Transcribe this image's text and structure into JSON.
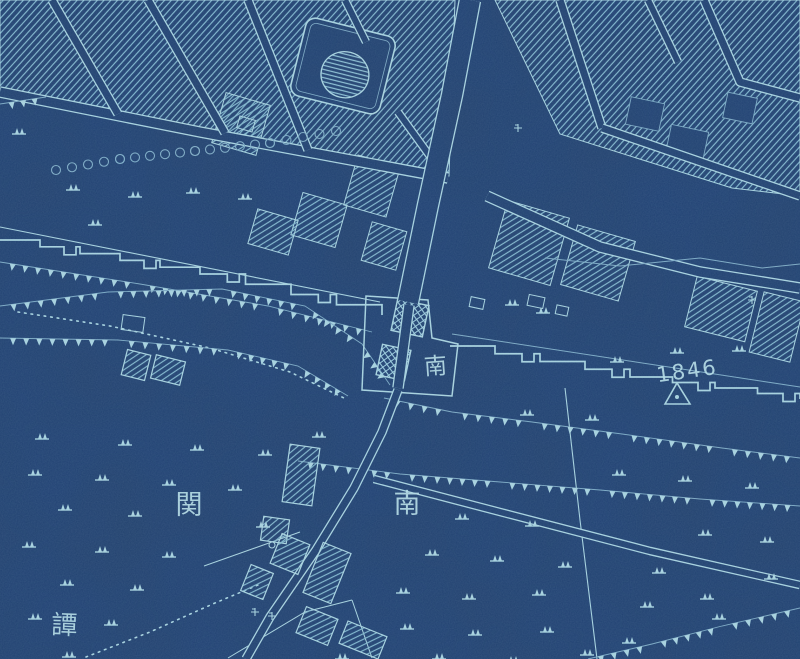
{
  "map": {
    "description_labels": {
      "gate_name": "南",
      "district_char_right": "南",
      "district_char_left": "関",
      "placename_partial": "譚",
      "survey_elevation": "1846"
    },
    "palette": {
      "background": "#21416d",
      "background_deep": "#1d3a63",
      "line": "#a9d1dd",
      "line_dim": "#7fa9c2",
      "hatch": "#84b6cb",
      "text": "#b6dae4"
    },
    "labels": [
      {
        "id": "gate-name-label",
        "text": "南",
        "x": 436,
        "y": 374,
        "size": 23,
        "rot": -4
      },
      {
        "id": "district-label-left",
        "text": "関",
        "x": 189,
        "y": 514,
        "size": 27,
        "rot": 0
      },
      {
        "id": "district-label-right",
        "text": "南",
        "x": 407,
        "y": 513,
        "size": 27,
        "rot": 0
      },
      {
        "id": "placename-label",
        "text": "譚",
        "x": 64,
        "y": 634,
        "size": 26,
        "rot": 2
      },
      {
        "id": "survey-elevation-label",
        "text": "1846",
        "x": 688,
        "y": 378,
        "size": 21,
        "rot": -8
      }
    ],
    "survey_marker": {
      "points": [
        [
          665,
          404
        ],
        [
          677,
          383
        ],
        [
          690,
          404
        ]
      ],
      "dot": [
        677,
        397
      ]
    },
    "geometry": {
      "block_polys": [
        [
          [
            0,
            0
          ],
          [
            455,
            0
          ],
          [
            449,
            176
          ],
          [
            0,
            95
          ]
        ],
        [
          [
            495,
            0
          ],
          [
            800,
            0
          ],
          [
            800,
            196
          ],
          [
            732,
            188
          ],
          [
            560,
            134
          ]
        ]
      ],
      "block_rects": [
        [
          296,
          198,
          46,
          44,
          16
        ],
        [
          350,
          160,
          44,
          52,
          16
        ],
        [
          366,
          226,
          36,
          40,
          16
        ],
        [
          252,
          214,
          42,
          36,
          16
        ],
        [
          218,
          98,
          46,
          52,
          16
        ],
        [
          497,
          208,
          64,
          70,
          16
        ],
        [
          568,
          232,
          60,
          62,
          16
        ],
        [
          690,
          283,
          62,
          52,
          14
        ],
        [
          756,
          296,
          42,
          62,
          14
        ]
      ],
      "court_rects": [
        [
          628,
          100,
          34,
          28,
          12
        ],
        [
          668,
          128,
          38,
          30,
          12
        ],
        [
          725,
          95,
          30,
          26,
          12
        ]
      ],
      "building_rects": [
        [
          124,
          352,
          24,
          26,
          14
        ],
        [
          153,
          358,
          30,
          24,
          14
        ],
        [
          286,
          446,
          30,
          58,
          8
        ],
        [
          262,
          518,
          26,
          24,
          8
        ],
        [
          275,
          538,
          30,
          32,
          22
        ],
        [
          312,
          546,
          30,
          54,
          22
        ],
        [
          245,
          568,
          24,
          28,
          22
        ],
        [
          300,
          612,
          34,
          28,
          22
        ],
        [
          342,
          628,
          42,
          24,
          22
        ]
      ],
      "outline_rects": [
        [
          122,
          316,
          22,
          15,
          8
        ],
        [
          238,
          118,
          16,
          12,
          16
        ],
        [
          528,
          296,
          16,
          11,
          12
        ],
        [
          556,
          306,
          12,
          9,
          12
        ],
        [
          470,
          298,
          14,
          10,
          12
        ]
      ],
      "gate_towers": [
        [
          394,
          302,
          32,
          32,
          12
        ],
        [
          379,
          347,
          29,
          31,
          12
        ]
      ],
      "gate_outline": [
        [
          366,
          296
        ],
        [
          362,
          390
        ],
        [
          452,
          396
        ],
        [
          458,
          344
        ],
        [
          432,
          338
        ],
        [
          428,
          300
        ]
      ],
      "enclosure": {
        "x": 297,
        "y": 26,
        "w": 92,
        "h": 80,
        "rot": 14,
        "rx": 10,
        "dome": {
          "cx": 347,
          "cy": 74,
          "rx": 24,
          "ry": 23
        }
      },
      "streets": [
        {
          "pts": [
            [
              0,
              92
            ],
            [
              200,
              132
            ],
            [
              448,
              178
            ]
          ],
          "w": 9
        },
        {
          "pts": [
            [
              487,
              196
            ],
            [
              600,
              247
            ],
            [
              700,
              272
            ],
            [
              800,
              288
            ]
          ],
          "w": 9
        },
        {
          "pts": [
            [
              52,
              0
            ],
            [
              118,
              114
            ]
          ],
          "w": 7
        },
        {
          "pts": [
            [
              148,
              0
            ],
            [
              225,
              133
            ]
          ],
          "w": 7
        },
        {
          "pts": [
            [
              248,
              0
            ],
            [
              308,
              150
            ]
          ],
          "w": 7
        },
        {
          "pts": [
            [
              345,
              0
            ],
            [
              366,
              42
            ]
          ],
          "w": 6
        },
        {
          "pts": [
            [
              398,
              112
            ],
            [
              440,
              170
            ]
          ],
          "w": 6
        },
        {
          "pts": [
            [
              560,
              0
            ],
            [
              602,
              128
            ]
          ],
          "w": 7
        },
        {
          "pts": [
            [
              648,
              0
            ],
            [
              678,
              62
            ]
          ],
          "w": 6
        },
        {
          "pts": [
            [
              704,
              0
            ],
            [
              740,
              82
            ],
            [
              800,
              98
            ]
          ],
          "w": 7
        },
        {
          "pts": [
            [
              602,
              128
            ],
            [
              800,
              196
            ]
          ],
          "w": 7
        }
      ],
      "roads": [
        {
          "pts": [
            [
              470,
              0
            ],
            [
              452,
              95
            ],
            [
              428,
              205
            ],
            [
              408,
              302
            ]
          ],
          "w": 20
        },
        {
          "pts": [
            [
              409,
              305
            ],
            [
              398,
              388
            ]
          ],
          "w": 9
        },
        {
          "pts": [
            [
              398,
              390
            ],
            [
              382,
              432
            ],
            [
              354,
              488
            ],
            [
              316,
              550
            ],
            [
              270,
              617
            ],
            [
              246,
              659
            ]
          ],
          "w": 7
        },
        {
          "pts": [
            [
              374,
              479
            ],
            [
              500,
              512
            ],
            [
              650,
              551
            ],
            [
              800,
              585
            ]
          ],
          "w": 6
        }
      ],
      "walls": [
        {
          "pts": [
            [
              0,
              240
            ],
            [
              200,
              274
            ],
            [
              382,
              315
            ]
          ]
        },
        {
          "pts": [
            [
              450,
              346
            ],
            [
              630,
              377
            ],
            [
              800,
              399
            ]
          ]
        }
      ],
      "thin_lines": [
        {
          "pts": [
            [
              0,
              227
            ],
            [
              380,
              302
            ]
          ],
          "w": 1.1,
          "dim": false
        },
        {
          "pts": [
            [
              452,
              334
            ],
            [
              800,
              387
            ]
          ],
          "w": 1,
          "dim": true
        },
        {
          "pts": [
            [
              565,
              388
            ],
            [
              580,
              520
            ],
            [
              597,
              659
            ]
          ],
          "w": 1.1,
          "dim": false
        },
        {
          "pts": [
            [
              545,
              258
            ],
            [
              620,
              266
            ],
            [
              700,
              258
            ],
            [
              762,
              268
            ],
            [
              800,
              264
            ]
          ],
          "w": 1,
          "dim": true
        },
        {
          "pts": [
            [
              204,
              566
            ],
            [
              300,
              532
            ]
          ],
          "w": 1,
          "dim": false
        },
        {
          "pts": [
            [
              228,
              658
            ],
            [
              305,
              612
            ],
            [
              352,
              600
            ]
          ],
          "w": 1,
          "dim": false
        },
        {
          "pts": [
            [
              352,
              600
            ],
            [
              372,
              658
            ]
          ],
          "w": 1,
          "dim": false
        }
      ],
      "hachure_rows": [
        {
          "pts": [
            [
              0,
              104
            ],
            [
              46,
              97
            ]
          ]
        },
        {
          "pts": [
            [
              0,
              262
            ],
            [
              140,
              284
            ],
            [
              268,
              306
            ],
            [
              372,
              332
            ]
          ]
        },
        {
          "pts": [
            [
              0,
              306
            ],
            [
              108,
              292
            ],
            [
              222,
              289
            ],
            [
              305,
              306
            ],
            [
              362,
              344
            ],
            [
              390,
              385
            ]
          ]
        },
        {
          "pts": [
            [
              0,
              338
            ],
            [
              118,
              340
            ],
            [
              228,
              350
            ],
            [
              298,
              366
            ],
            [
              348,
              396
            ]
          ]
        },
        {
          "pts": [
            [
              384,
              398
            ],
            [
              452,
              412
            ],
            [
              532,
              422
            ],
            [
              622,
              434
            ],
            [
              722,
              448
            ],
            [
              800,
              458
            ]
          ]
        },
        {
          "pts": [
            [
              298,
              461
            ],
            [
              400,
              474
            ],
            [
              500,
              482
            ],
            [
              600,
              490
            ],
            [
              700,
              499
            ],
            [
              800,
              506
            ]
          ]
        },
        {
          "pts": [
            [
              588,
              659
            ],
            [
              652,
              644
            ],
            [
              722,
              626
            ],
            [
              800,
              608
            ]
          ]
        }
      ],
      "dotted": [
        {
          "pts": [
            [
              18,
              312
            ],
            [
              110,
              326
            ],
            [
              210,
              348
            ],
            [
              290,
              372
            ],
            [
              344,
              398
            ]
          ]
        },
        {
          "pts": [
            [
              86,
              657
            ],
            [
              150,
              632
            ],
            [
              215,
              603
            ],
            [
              258,
              585
            ]
          ]
        }
      ],
      "scallop_row": {
        "pts": [
          [
            56,
            170
          ],
          [
            120,
            159
          ],
          [
            195,
            151
          ],
          [
            270,
            143
          ],
          [
            336,
            131
          ]
        ],
        "r": 4.5,
        "gap": 15
      },
      "small_circle": [
        272,
        545,
        3
      ],
      "small_marks": [
        [
          518,
          128
        ],
        [
          255,
          612
        ],
        [
          272,
          616
        ],
        [
          752,
          300
        ]
      ],
      "field_symbols": [
        [
          12,
          127
        ],
        [
          66,
          183
        ],
        [
          128,
          190
        ],
        [
          186,
          186
        ],
        [
          238,
          192
        ],
        [
          88,
          218
        ],
        [
          505,
          298
        ],
        [
          536,
          306
        ],
        [
          670,
          346
        ],
        [
          732,
          344
        ],
        [
          610,
          355
        ],
        [
          520,
          408
        ],
        [
          585,
          413
        ],
        [
          312,
          430
        ],
        [
          35,
          432
        ],
        [
          118,
          438
        ],
        [
          190,
          443
        ],
        [
          258,
          448
        ],
        [
          28,
          468
        ],
        [
          95,
          473
        ],
        [
          162,
          478
        ],
        [
          228,
          483
        ],
        [
          612,
          468
        ],
        [
          678,
          474
        ],
        [
          745,
          481
        ],
        [
          58,
          503
        ],
        [
          128,
          509
        ],
        [
          256,
          520
        ],
        [
          455,
          512
        ],
        [
          525,
          519
        ],
        [
          22,
          540
        ],
        [
          95,
          545
        ],
        [
          162,
          550
        ],
        [
          425,
          548
        ],
        [
          490,
          554
        ],
        [
          558,
          560
        ],
        [
          652,
          566
        ],
        [
          698,
          528
        ],
        [
          760,
          535
        ],
        [
          60,
          578
        ],
        [
          130,
          583
        ],
        [
          396,
          586
        ],
        [
          462,
          592
        ],
        [
          532,
          588
        ],
        [
          700,
          592
        ],
        [
          764,
          572
        ],
        [
          28,
          612
        ],
        [
          104,
          618
        ],
        [
          400,
          622
        ],
        [
          468,
          628
        ],
        [
          540,
          625
        ],
        [
          622,
          636
        ],
        [
          712,
          612
        ],
        [
          640,
          600
        ],
        [
          62,
          650
        ],
        [
          335,
          652
        ],
        [
          432,
          652
        ],
        [
          506,
          655
        ],
        [
          580,
          648
        ]
      ]
    }
  }
}
